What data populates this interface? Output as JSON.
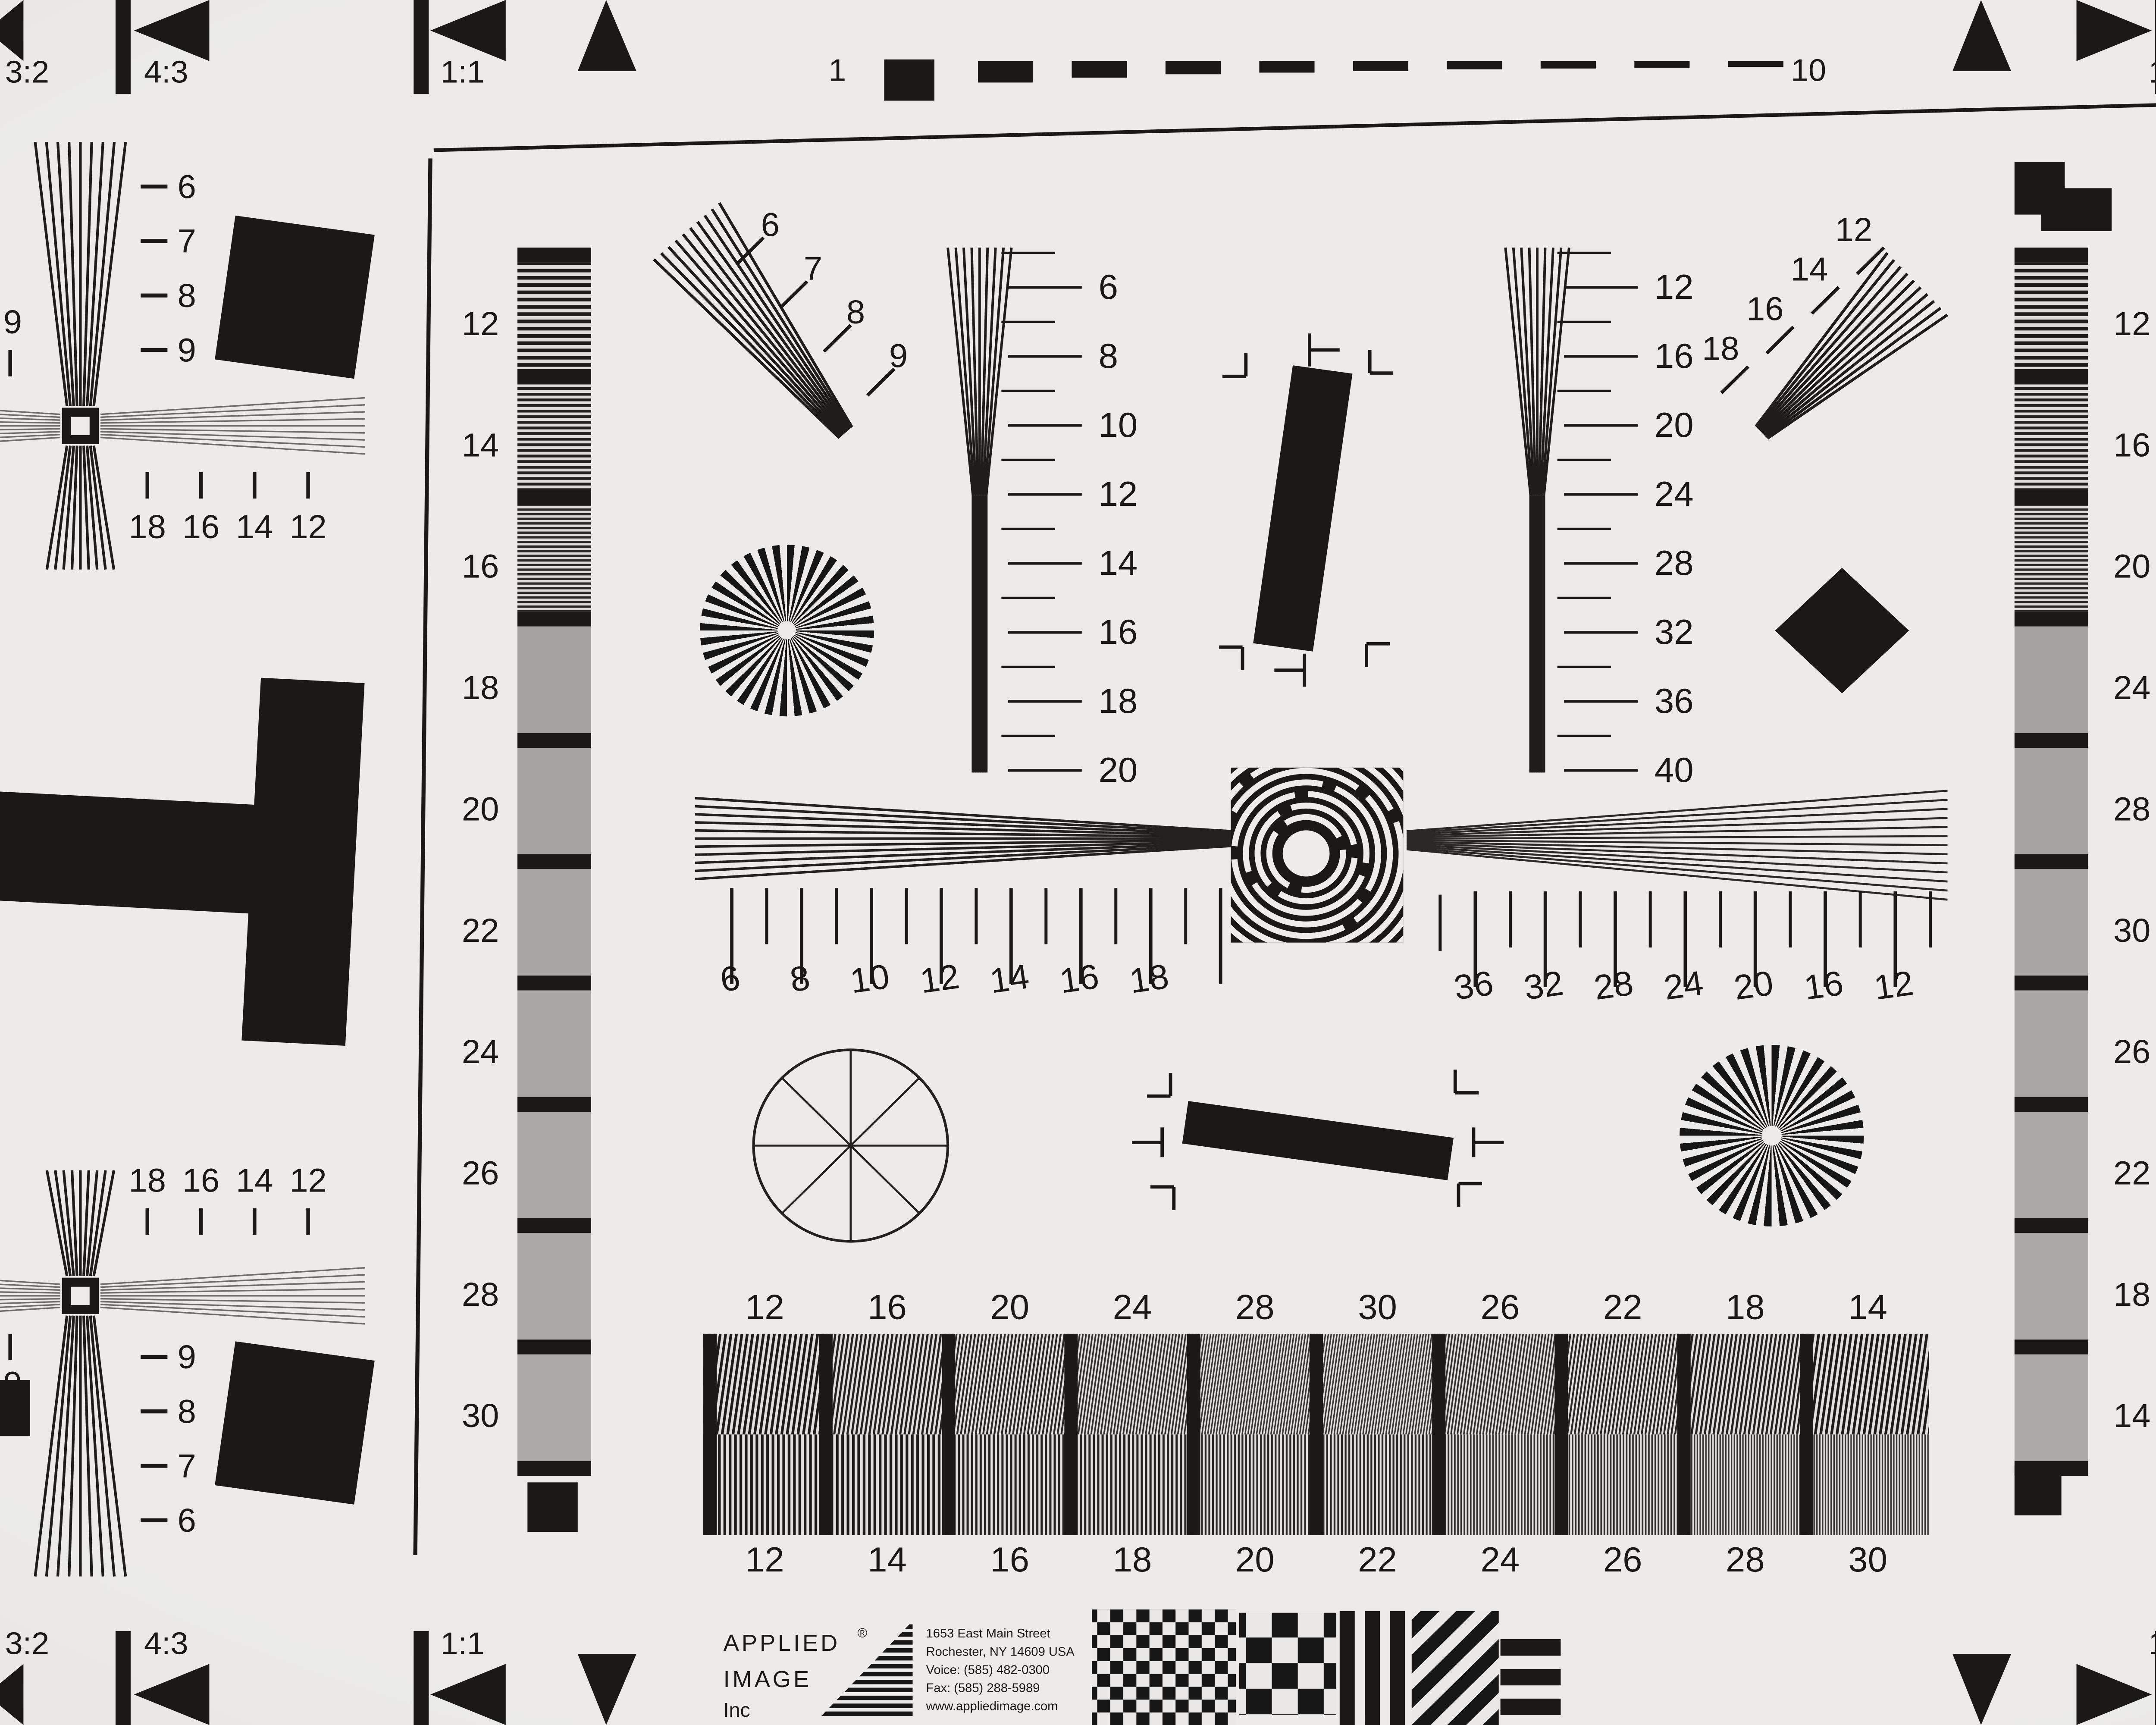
{
  "corner_markers": {
    "tl": [
      "3:2",
      "4:3",
      "1:1"
    ],
    "tr": [
      "1:1",
      "4:3",
      "3:2"
    ],
    "bl": [
      "3:2",
      "4:3",
      "1:1"
    ],
    "br": [
      "1:1",
      "4:3",
      "3:2"
    ]
  },
  "top_ruler": {
    "start": "1",
    "end": "10"
  },
  "edge_labels": {
    "left_top": "9",
    "right_top": "9",
    "left_bottom": "9",
    "right_bottom": "9"
  },
  "crosses": {
    "left_top": {
      "wedge_labels": [
        "6",
        "7",
        "8",
        "9"
      ],
      "tick_labels": [
        "18",
        "16",
        "14",
        "12"
      ]
    },
    "left_bottom": {
      "tick_labels": [
        "18",
        "16",
        "14",
        "12"
      ],
      "wedge_labels": [
        "9",
        "8",
        "7",
        "6"
      ]
    },
    "right_top": {
      "wedge_labels": [
        "6",
        "7",
        "8",
        "9"
      ],
      "tick_labels": [
        "12",
        "14",
        "16",
        "18"
      ]
    },
    "right_bottom": {
      "tick_labels": [
        "12",
        "14",
        "16",
        "18"
      ],
      "wedge_labels": [
        "9",
        "8",
        "7",
        "6"
      ]
    }
  },
  "diag_wedge_tl": [
    "6",
    "7",
    "8",
    "9"
  ],
  "diag_wedge_tr": [
    "12",
    "14",
    "16",
    "18"
  ],
  "vertical_scale_left": [
    "6",
    "8",
    "10",
    "12",
    "14",
    "16",
    "18",
    "20"
  ],
  "vertical_scale_right": [
    "12",
    "16",
    "20",
    "24",
    "28",
    "32",
    "36",
    "40"
  ],
  "horizontal_scale_left": [
    "6",
    "8",
    "10",
    "12",
    "14",
    "16",
    "18"
  ],
  "horizontal_scale_right": [
    "36",
    "32",
    "28",
    "24",
    "20",
    "16",
    "12"
  ],
  "gray_column_left": [
    "12",
    "14",
    "16",
    "18",
    "20",
    "22",
    "24",
    "26",
    "28",
    "30"
  ],
  "gray_column_right": [
    "12",
    "16",
    "20",
    "24",
    "28",
    "30",
    "26",
    "22",
    "18",
    "14"
  ],
  "bottom_bar": {
    "top_labels": [
      "12",
      "16",
      "20",
      "24",
      "28",
      "30",
      "26",
      "22",
      "18",
      "14"
    ],
    "bottom_labels": [
      "12",
      "14",
      "16",
      "18",
      "20",
      "22",
      "24",
      "26",
      "28",
      "30"
    ]
  },
  "logo": {
    "line1": "APPLIED",
    "reg": "®",
    "line2": "IMAGE",
    "line3": "Inc",
    "address": [
      "1653 East Main Street",
      "Rochester, NY  14609  USA",
      "Voice:  (585) 482-0300",
      "Fax:    (585) 288-5989",
      "www.appliedimage.com"
    ]
  },
  "colors": {
    "paper": "#e9e8e6",
    "ink": "#1a1918",
    "gray_line": "#6f6d6a"
  }
}
